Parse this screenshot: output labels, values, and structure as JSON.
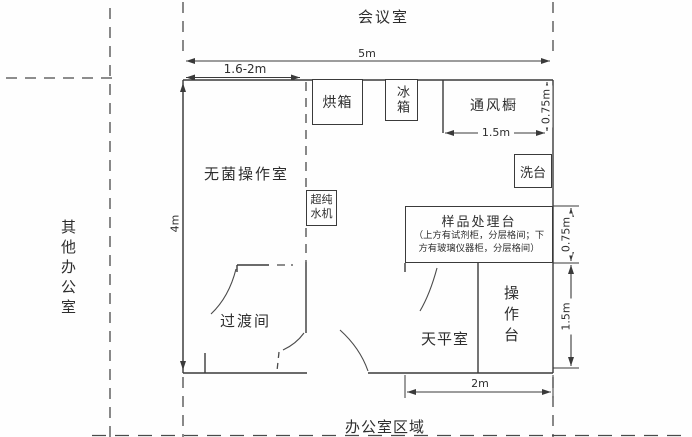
{
  "context": {
    "top_label": "会议室",
    "left_label": "其他办公室",
    "bottom_label": "办公室区域"
  },
  "rooms": {
    "sterile": "无菌操作室",
    "transition": "过渡间",
    "balance": "天平室",
    "bench": "操作台",
    "fume_hood": "通风橱"
  },
  "fixtures": {
    "oven": "烘箱",
    "fridge": "冰箱",
    "sink": "洗台",
    "water_purifier": "超纯水机",
    "sample_bench": {
      "title": "样品处理台",
      "note_line1": "（上方有试剂柜，分层格间；下",
      "note_line2": "方有玻璃仪器柜，分层格间）"
    }
  },
  "dimensions": {
    "total_width": "5m",
    "sterile_width": "1.6-2m",
    "total_height": "4m",
    "fume_hood_depth": "0.75m",
    "fume_hood_width": "1.5m",
    "sample_bench_depth": "0.75m",
    "bench_length": "1.5m",
    "balance_area_width": "2m"
  },
  "colors": {
    "line": "#3a3a3a",
    "text": "#2e2e2e",
    "background": "#fefefe"
  }
}
